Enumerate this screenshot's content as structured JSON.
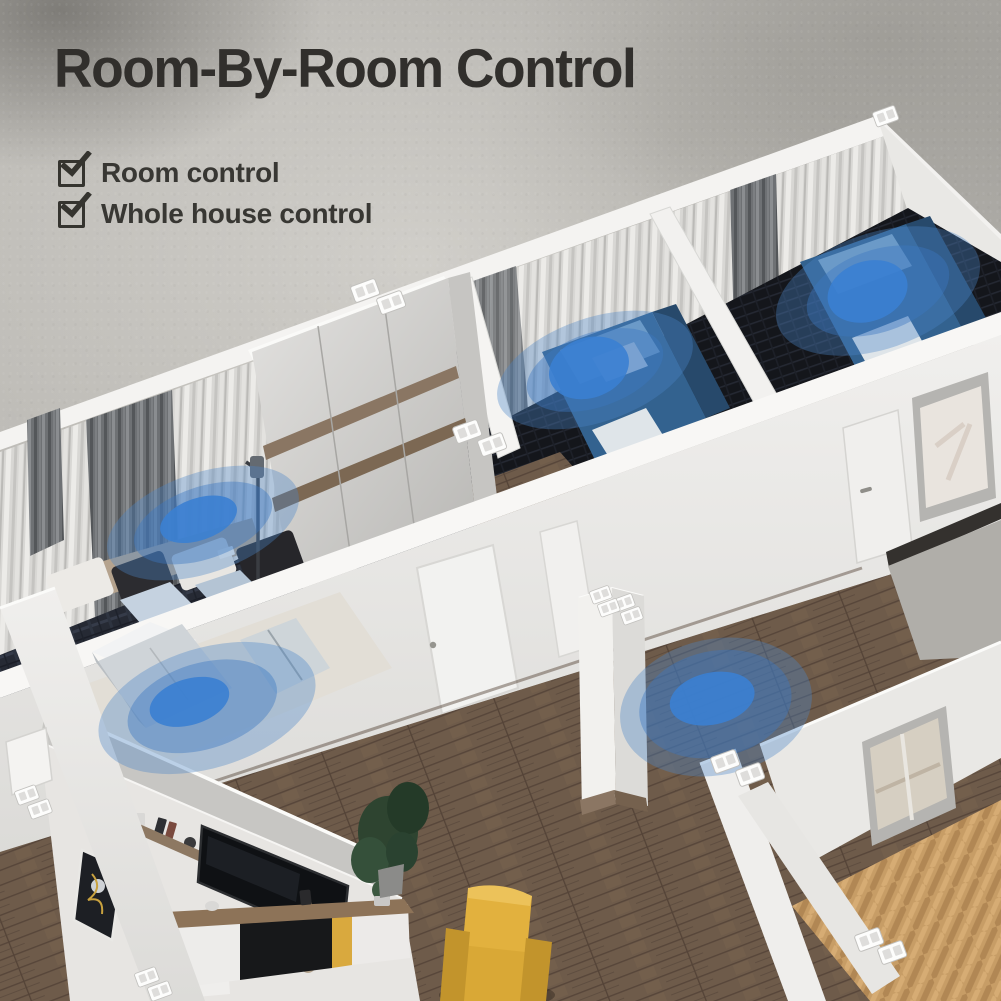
{
  "header": {
    "title": "Room-By-Room Control"
  },
  "checklist": {
    "items": [
      {
        "label": "Room control",
        "checked": true
      },
      {
        "label": "Whole house control",
        "checked": true
      }
    ]
  },
  "scene": {
    "type": "isometric-home-cutaway-render",
    "zone_markers": [
      "bedroom-left",
      "bedroom-middle",
      "bedroom-right",
      "hallway",
      "bathroom"
    ],
    "colors": {
      "signal_inner": "#3b7fd2",
      "signal_ring": "#3c78c2",
      "signal_outer": "#4a86c8",
      "concrete": "#b5b3ae",
      "title": "#312f2c"
    }
  }
}
